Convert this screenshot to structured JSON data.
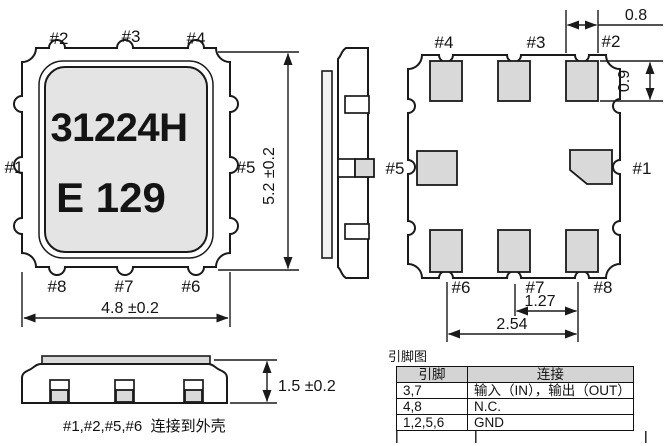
{
  "top_view": {
    "marking": {
      "line1": "31224H",
      "line2": "E 129"
    },
    "pins": {
      "p1": "#1",
      "p2": "#2",
      "p3": "#3",
      "p4": "#4",
      "p5": "#5",
      "p6": "#6",
      "p7": "#7",
      "p8": "#8"
    },
    "dims": {
      "body_width": "4.8 ±0.2",
      "body_height": "5.2 ±0.2"
    }
  },
  "bottom_view": {
    "pins": {
      "p1": "#1",
      "p2": "#2",
      "p3": "#3",
      "p4": "#4",
      "p5": "#5",
      "p6": "#6",
      "p7": "#7",
      "p8": "#8"
    },
    "dims": {
      "pad_width": "0.8",
      "pad_height": "0.9",
      "pitch_1": "1.27",
      "pitch_2": "2.54"
    }
  },
  "front_view": {
    "dims": {
      "height": "1.5 ±0.2"
    }
  },
  "note": "#1,#2,#5,#6  连接到外壳",
  "pin_table": {
    "title": "引脚图",
    "headers": [
      "引脚",
      "连接"
    ],
    "rows": [
      [
        "3,7",
        "输入（IN），输出（OUT）"
      ],
      [
        "4,8",
        "N.C."
      ],
      [
        "1,2,5,6",
        "GND"
      ]
    ]
  },
  "colors": {
    "line": "#1a1a1a",
    "pad_fill": "#d9d9d9",
    "lid_fill": "#e4e4e4",
    "table_header_fill": "#d4d4d4"
  }
}
